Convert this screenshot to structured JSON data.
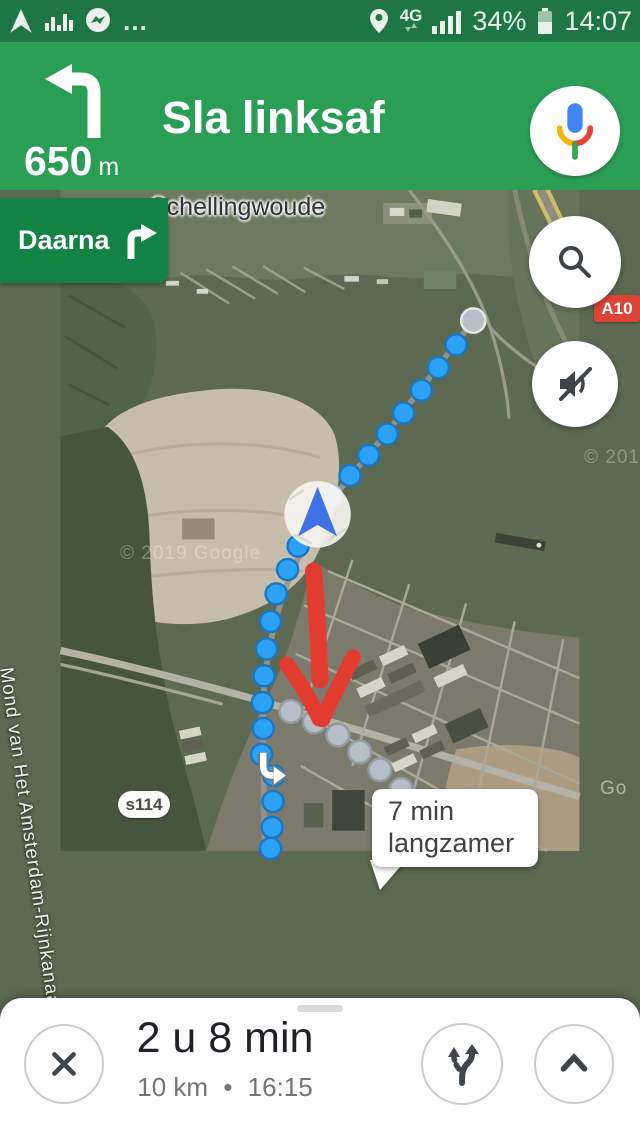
{
  "status_bar": {
    "network": "4G",
    "battery": "34%",
    "time": "14:07",
    "more": "…"
  },
  "banner": {
    "distance": "650",
    "unit": "m",
    "instruction": "Sla linksaf"
  },
  "chip": {
    "label": "Daarna"
  },
  "map": {
    "place": "Schellingwoude",
    "canal": "Mond van Het Amsterdam-Rijnkanaal",
    "s_road": "s114",
    "motorway": "A10",
    "callout_line1": "7 min",
    "callout_line2": "langzamer",
    "wm_center": "© 2019 Google",
    "wm_right": "© 201",
    "wm_edge": "Go"
  },
  "sheet": {
    "duration": "2 u 8 min",
    "distance": "10 km",
    "dot": "•",
    "eta": "16:15"
  },
  "colors": {
    "status_green": "#1d7643",
    "banner_green": "#2b9e56",
    "chip_green": "#128343",
    "route_blue": "#2da2f4",
    "alt_gray": "#b7bec6",
    "alert_red": "#e23c30",
    "motorway_red": "#dc4437"
  }
}
